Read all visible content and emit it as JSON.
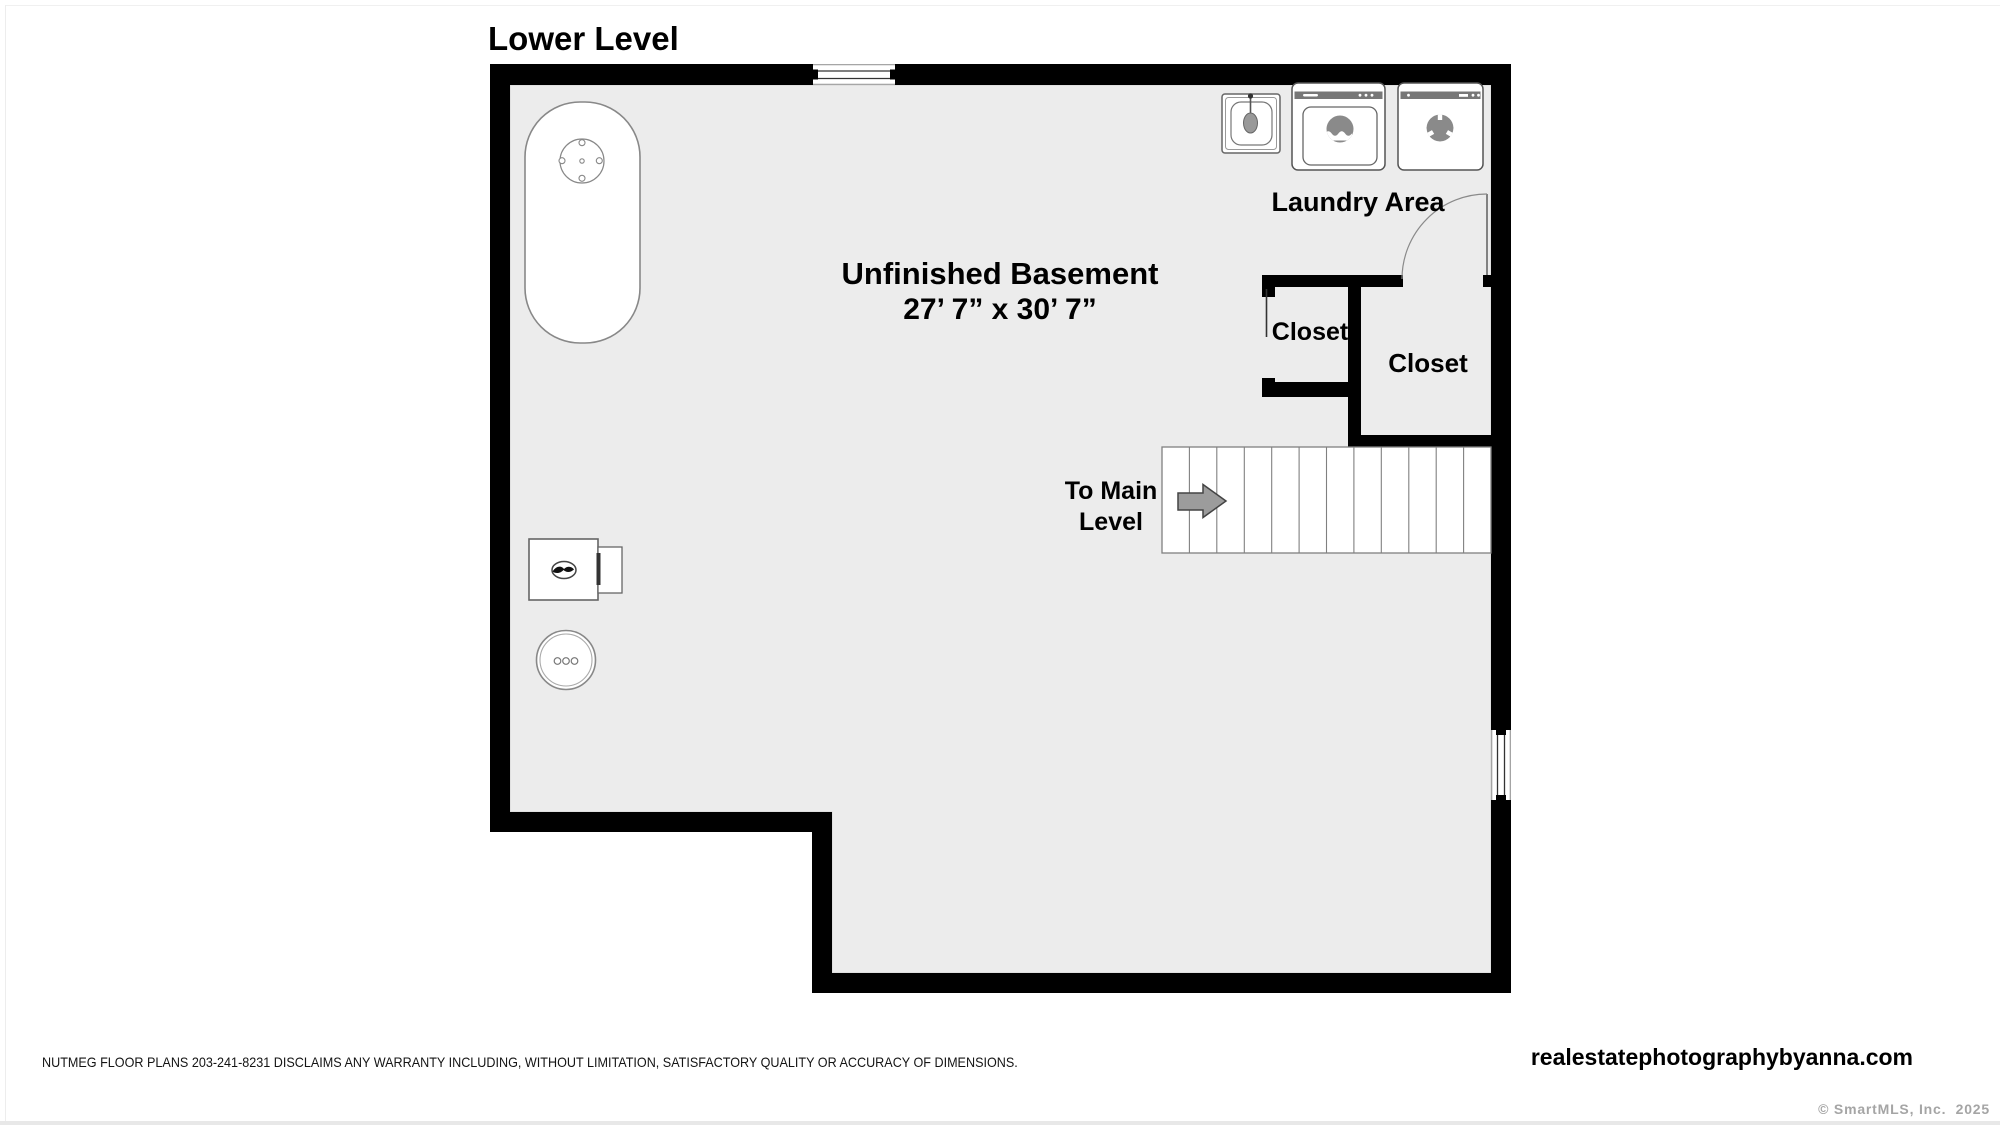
{
  "page": {
    "title": "Lower Level"
  },
  "plan": {
    "room": {
      "name": "Unfinished Basement",
      "dimensions": "27’ 7” x 30’ 7”"
    },
    "laundry": {
      "label": "Laundry Area",
      "appliances": [
        "sink",
        "washer",
        "dryer"
      ]
    },
    "closets": [
      {
        "label": "Closet"
      },
      {
        "label": "Closet"
      }
    ],
    "stairs": {
      "label_line1": "To Main",
      "label_line2": "Level",
      "direction": "right",
      "treads": 12
    },
    "equipment": [
      "water-heater",
      "furnace",
      "oil-tank"
    ],
    "colors": {
      "wall": "#000000",
      "floor": "#ececec",
      "appliance_outline": "#666666",
      "glyph_gray": "#8a8a8a",
      "stair_line": "#808080",
      "arrow_fill": "#9c9c9c"
    }
  },
  "footer": {
    "disclaimer": "NUTMEG FLOOR PLANS 203-241-8231 DISCLAIMS ANY WARRANTY INCLUDING, WITHOUT LIMITATION, SATISFACTORY QUALITY OR ACCURACY OF DIMENSIONS.",
    "website": "realestatephotographybyanna.com",
    "copyright": "© SmartMLS, Inc.  2025"
  }
}
